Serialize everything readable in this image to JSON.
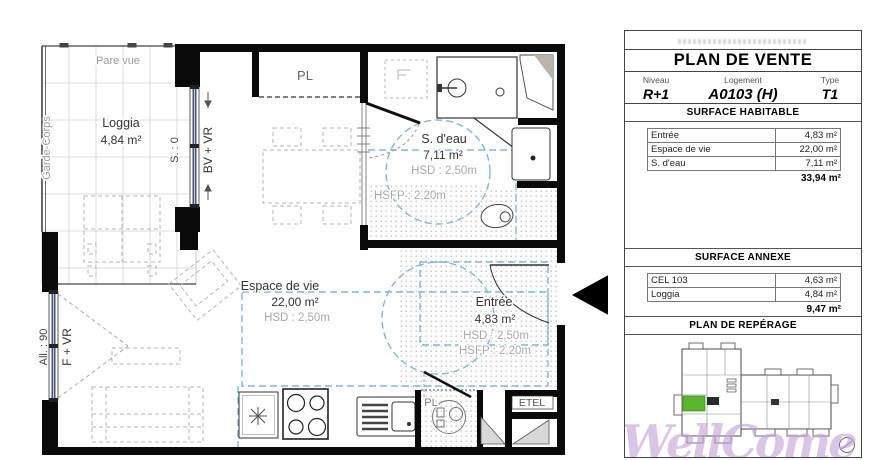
{
  "plan": {
    "loggia": {
      "pare_vue": "Pare vue",
      "garde_corps": "Garde-Corps",
      "name": "Loggia",
      "area": "4,84 m²",
      "s0": "S. : 0"
    },
    "windows": {
      "bv_vr": "BV + VR",
      "f_vr": "F + VR",
      "all90": "All. : 90"
    },
    "espace": {
      "name": "Espace de vie",
      "area": "22,00 m²",
      "hsd": "HSD : 2,50m"
    },
    "sdeau": {
      "name": "S. d'eau",
      "area": "7,11 m²",
      "hsd": "HSD : 2,50m",
      "hsfp": "HSFP : 2,20m"
    },
    "entree": {
      "name": "Entrée",
      "area": "4,83 m²",
      "hsd": "HSD : 2,50m",
      "hsfp": "HSFP : 2,20m"
    },
    "closets": {
      "pl_top": "PL",
      "pl_bottom": "PL",
      "etel": "ETEL"
    }
  },
  "panel": {
    "title": "PLAN DE VENTE",
    "fields": {
      "niveau_label": "Niveau",
      "niveau": "R+1",
      "logement_label": "Logement",
      "logement": "A0103 (H)",
      "type_label": "Type",
      "type": "T1"
    },
    "surface_habitable": {
      "title": "SURFACE HABITABLE",
      "rows": [
        {
          "label": "Entrée",
          "value": "4,83 m²"
        },
        {
          "label": "Espace de vie",
          "value": "22,00 m²"
        },
        {
          "label": "S. d'eau",
          "value": "7,11 m²"
        }
      ],
      "total": "33,94 m²"
    },
    "surface_annexe": {
      "title": "SURFACE ANNEXE",
      "rows": [
        {
          "label": "CEL 103",
          "value": "4,63 m²"
        },
        {
          "label": "Loggia",
          "value": "4,84 m²"
        }
      ],
      "total": "9,47 m²"
    },
    "reperage": {
      "title": "PLAN DE REPÉRAGE"
    },
    "watermark": "WellCome",
    "colors": {
      "highlight_green": "#5cb52e",
      "watermark_purple": "#c2a0d6",
      "window_blue": "#46537f",
      "zone_blue": "#7fb8dc"
    }
  }
}
